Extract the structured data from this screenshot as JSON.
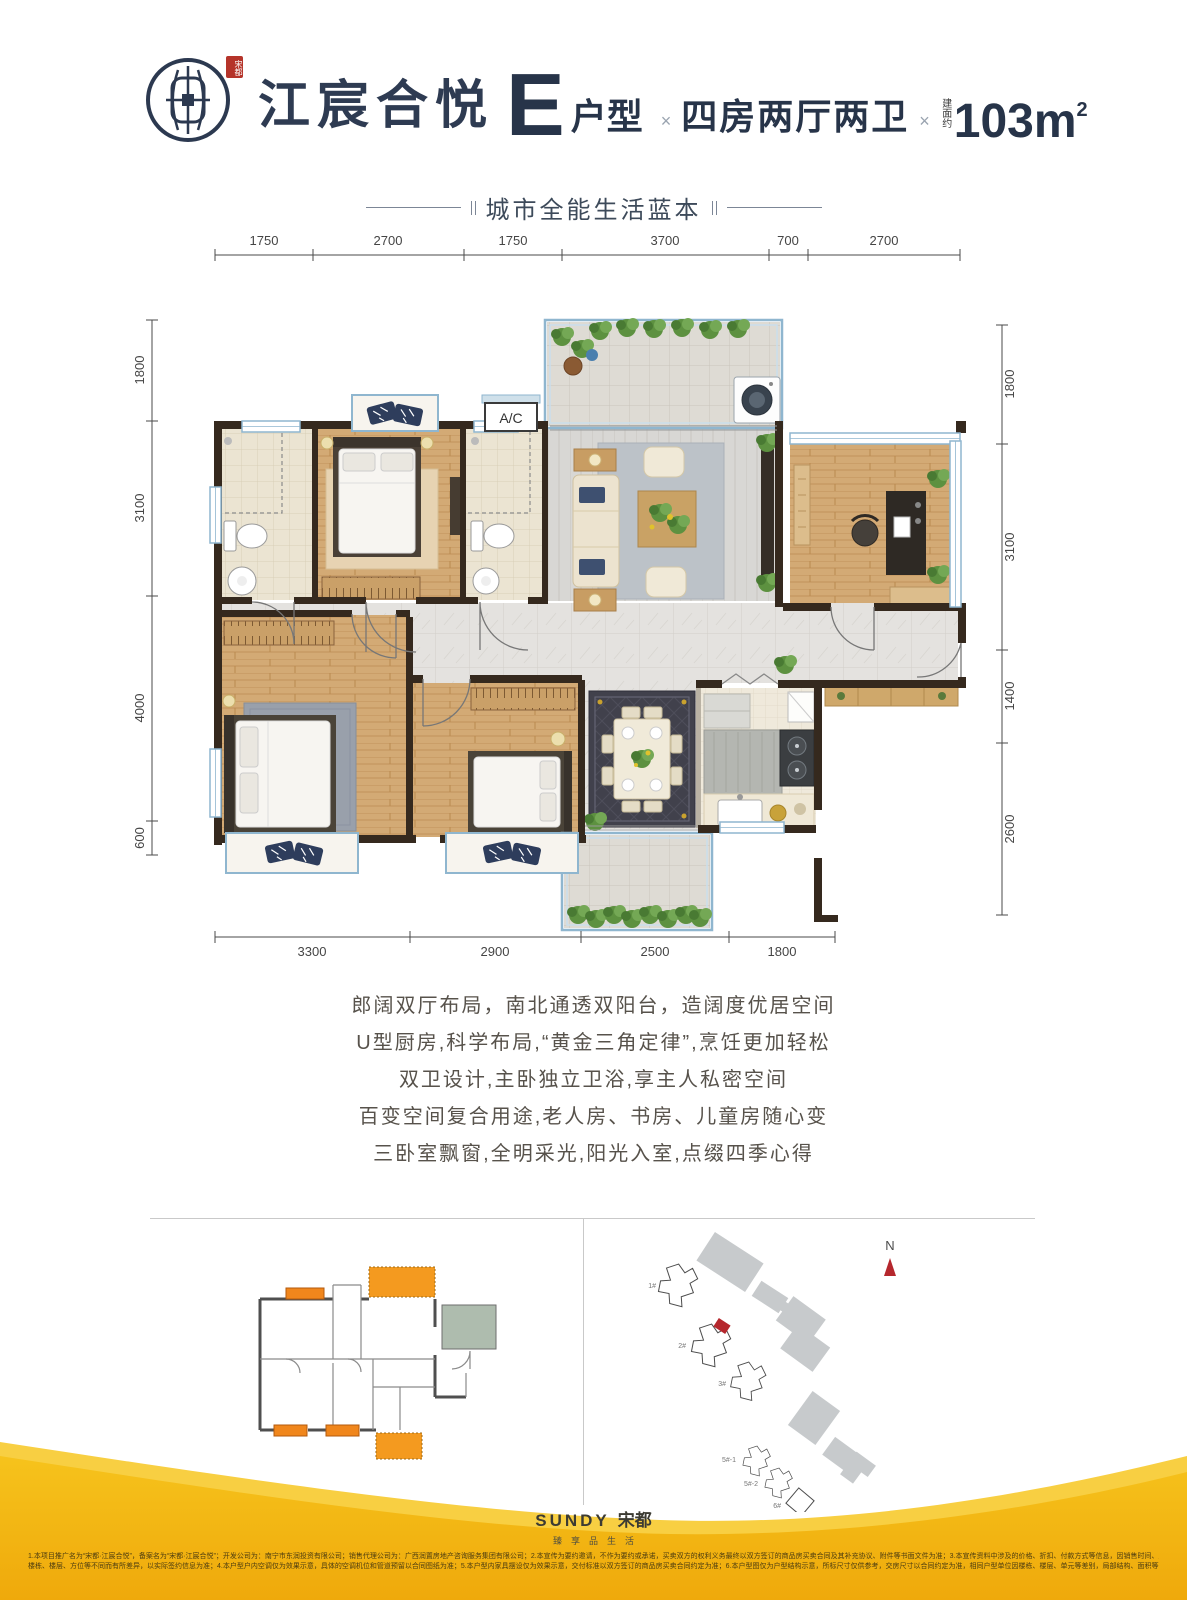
{
  "header": {
    "seal": "宋都",
    "brand": "江宸合悦",
    "unit_letter": "E",
    "unit_suffix": "户型",
    "multiply": "×",
    "layout": "四房两厅两卫",
    "area_label": "建面约",
    "area_value": "103m",
    "area_exp": "2"
  },
  "subtitle": {
    "text": "城市全能生活蓝本"
  },
  "plan": {
    "ac_label": "A/C",
    "dims_top": [
      "1750",
      "2700",
      "1750",
      "3700",
      "700",
      "2700"
    ],
    "dims_left": [
      "1800",
      "3100",
      "4000",
      "600"
    ],
    "dims_right": [
      "1800",
      "3100",
      "1400",
      "2600"
    ],
    "dims_bottom": [
      "3300",
      "2900",
      "2500",
      "1800"
    ]
  },
  "features": {
    "lines": [
      "郎阔双厅布局，南北通透双阳台，造阔度优居空间",
      "U型厨房,科学布局,“黄金三角定律”,烹饪更加轻松",
      "双卫设计,主卧独立卫浴,享主人私密空间",
      "百变空间复合用途,老人房、书房、儿童房随心变",
      "三卧室飘窗,全明采光,阳光入室,点缀四季心得"
    ]
  },
  "site_plan": {
    "north": "N",
    "labels": [
      "1#",
      "2#",
      "3#",
      "5#-1",
      "5#-2",
      "6#"
    ]
  },
  "footer": {
    "logo_en": "SUNDY",
    "logo_cn": "宋都",
    "tagline": "臻享品生活",
    "disclaimer1": "1.本项目推广名为“宋都·江宸合悦”，备案名为“宋都·江宸合悦”；开发公司为：南宁市东润投资有限公司；销售代理公司为：广西润置房地产咨询服务集团有限公司；2.本宣传为要约邀请，不作为要约或承诺，买卖双方的权利义务最终以双方签订的商品房买卖合同及其补充协议、附件等书面文件为准；3.本宣传资料中涉及的价格、折扣、付款方式等信息，因销售时间、户型、",
    "disclaimer2": "楼栋、楼层、方位等不同而有所差异，以实际签约信息为准；4.本户型户内空调仅为效果示意，具体的空调机位和管道预留以合同图纸为准；5.本户型内家具摆设仅为效果示意，交付标准以双方签订的商品房买卖合同约定为准；6.本户型图仅为户型结构示意，所标尺寸仅供参考，交房尺寸以合同约定为准，相同户型单位因楼栋、楼层、单元等差别，局部结构、面积等可能不同。"
  },
  "colors": {
    "accent_navy": "#2c3950",
    "seal_red": "#b5342a",
    "gold": "#f5bd10",
    "wave_light": "#f8cf42",
    "plan_wall": "#35291e",
    "window_blue": "#8fb6cf",
    "highlight_orange": "#f49a1f",
    "site_red": "#b5272d"
  }
}
